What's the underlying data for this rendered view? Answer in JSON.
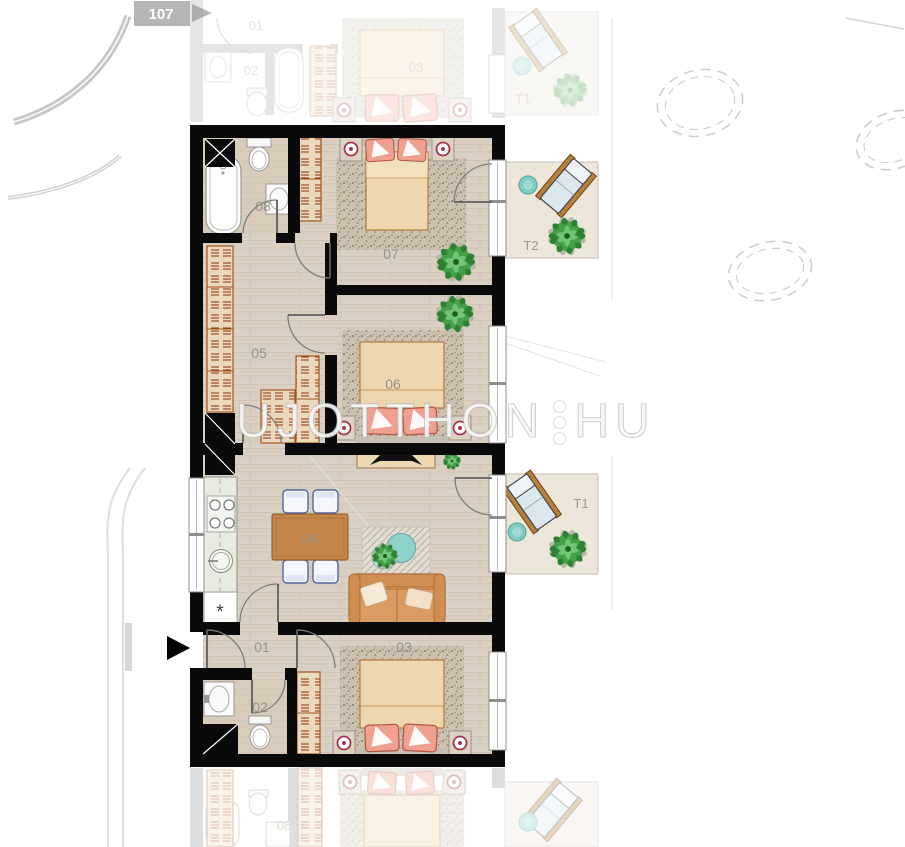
{
  "site": {
    "unit_tag": "107"
  },
  "watermark": {
    "left": "UJOTTHON",
    "right": "HU"
  },
  "apartment": {
    "rooms": [
      {
        "id": "01",
        "label": "01"
      },
      {
        "id": "02",
        "label": "02"
      },
      {
        "id": "03",
        "label": "03"
      },
      {
        "id": "04",
        "label": "04"
      },
      {
        "id": "05",
        "label": "05"
      },
      {
        "id": "06",
        "label": "06"
      },
      {
        "id": "07",
        "label": "07"
      },
      {
        "id": "08",
        "label": "08"
      }
    ],
    "terraces": [
      {
        "id": "T1",
        "label": "T1"
      },
      {
        "id": "T2",
        "label": "T2"
      }
    ],
    "symbols": {
      "washing_machine": "*"
    }
  },
  "faded": {
    "upper": {
      "labels": [
        "01",
        "02",
        "03",
        "T1"
      ]
    },
    "lower": {
      "labels": [
        "08"
      ]
    }
  },
  "colors": {
    "wall": "#0a0a0a",
    "floor": "#d9cfc2",
    "terrace_floor": "#ede6db",
    "wardrobe": "#93300f",
    "plant": "#2f8132",
    "pillow": "#f0a090",
    "sofa": "#db9c63",
    "dining_table": "#c4854a",
    "chair_outline": "#55689f",
    "coffee_table": "#8fd2cb",
    "label": "#96918a",
    "watermark": "#ffffff"
  }
}
